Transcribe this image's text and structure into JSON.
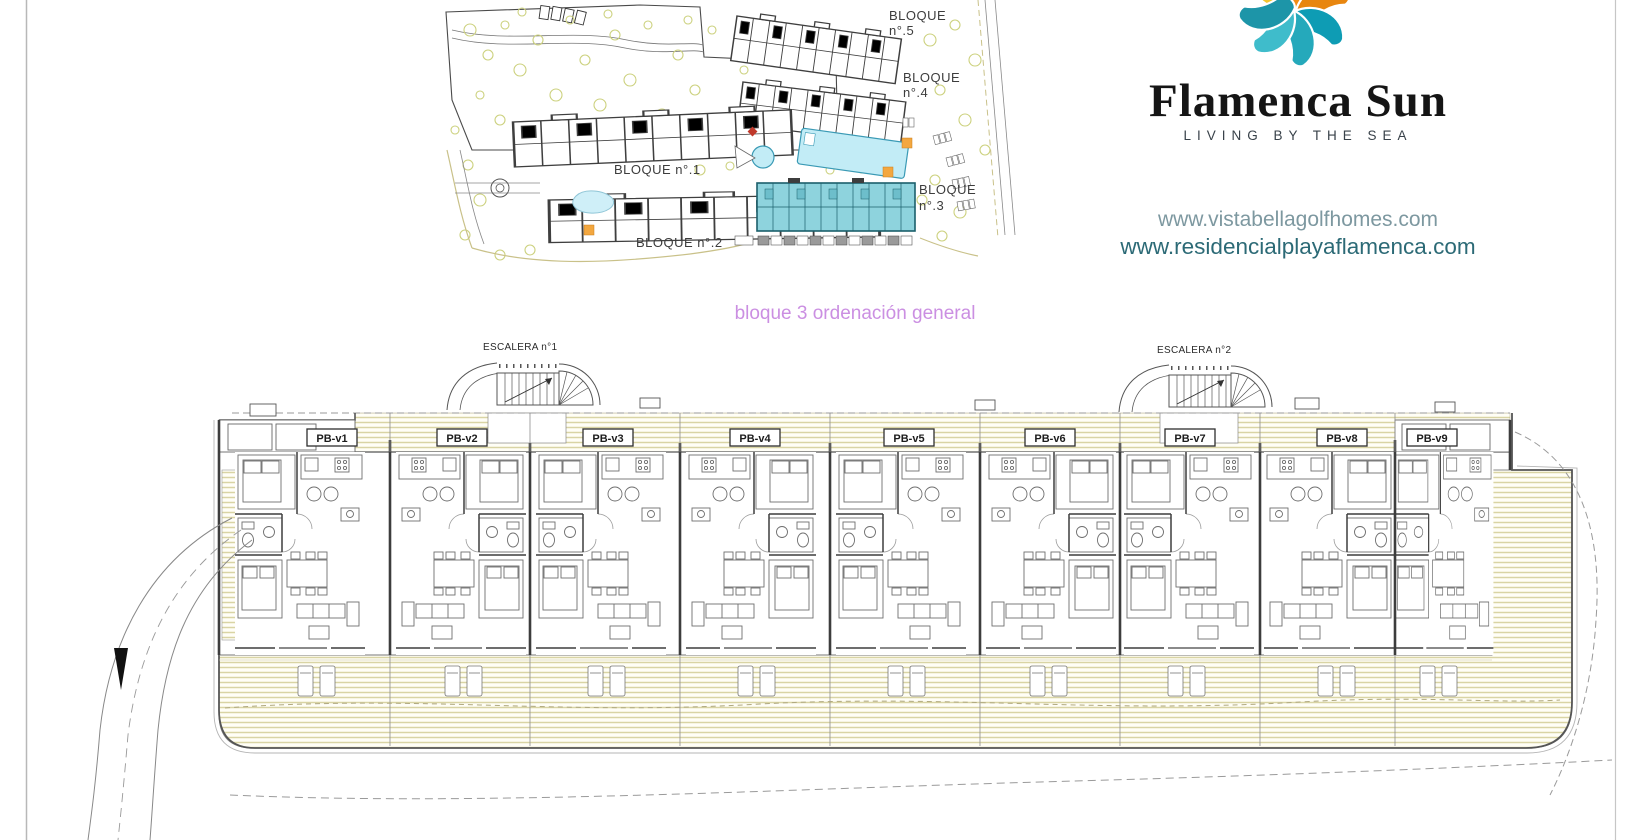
{
  "page": {
    "background": "#ffffff",
    "border_color": "#b8b8b8"
  },
  "branding": {
    "name": "Flamenca Sun",
    "tagline": "LIVING BY THE SEA",
    "url_primary": "www.vistabellagolfhomes.com",
    "url_secondary": "www.residencialplayaflamenca.com",
    "logo_colors": {
      "yellow": "#f4c430",
      "orange": "#f28c15",
      "teal": "#2aa3b5",
      "teal_dark": "#0e9cb4",
      "teal_light": "#3fbccb"
    }
  },
  "caption": {
    "text": "bloque 3 ordenación general",
    "color": "#cb8fe2"
  },
  "site_plan": {
    "labels": {
      "bloque5": [
        "BLOQUE",
        "n°.5"
      ],
      "bloque4": [
        "BLOQUE",
        "n°.4"
      ],
      "bloque1": "BLOQUE n°.1",
      "bloque3": [
        "BLOQUE",
        "n°.3"
      ],
      "bloque2": "BLOQUE n°.2"
    },
    "colors": {
      "highlight_block": "#8ed3dd",
      "pool": "#c2ecf6",
      "tree": "#ccd17e",
      "orange_marker": "#f3a73f",
      "red_marker": "#c0392b",
      "outline": "#3f3f3f"
    }
  },
  "floor_plan": {
    "escalera1": "ESCALERA n°1",
    "escalera2": "ESCALERA n°2",
    "units": [
      "PB-v1",
      "PB-v2",
      "PB-v3",
      "PB-v4",
      "PB-v5",
      "PB-v6",
      "PB-v7",
      "PB-v8",
      "PB-v9"
    ],
    "hatch_color": "#d9d4a4",
    "wall_color": "#3d3d3d"
  }
}
